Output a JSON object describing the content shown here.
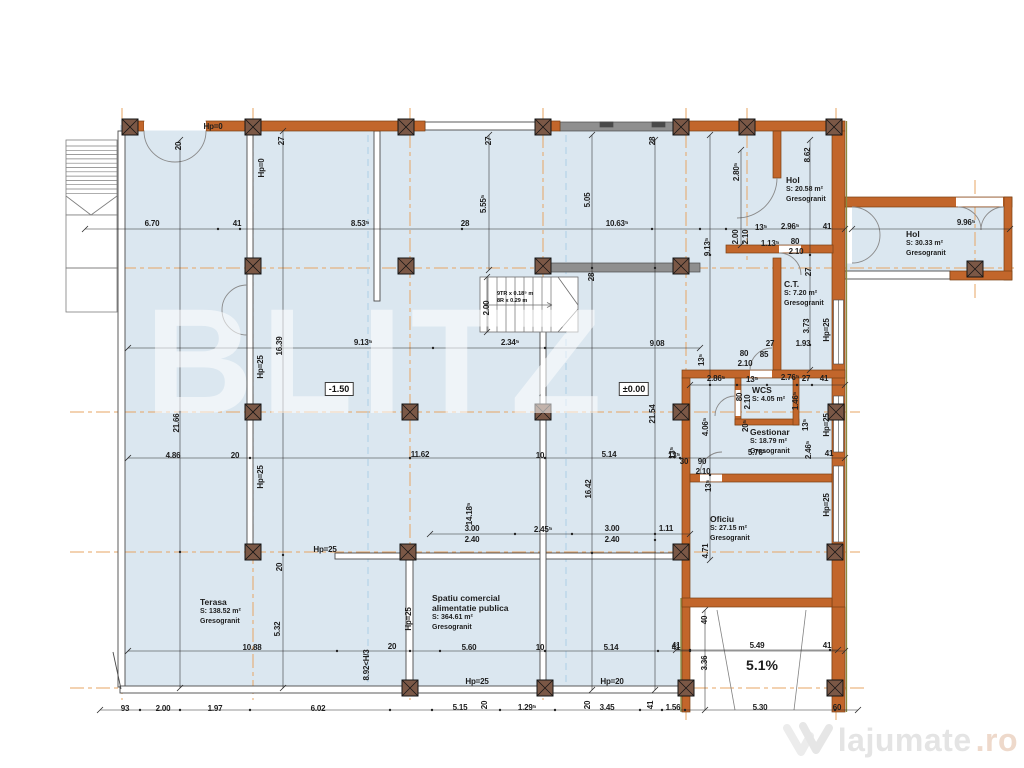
{
  "plan_watermark": "BLITZ",
  "watermark": {
    "brand": "lajumate",
    "tld": ".ro",
    "logo": "w-heart-icon"
  },
  "plan": {
    "levels": [
      {
        "t": "-1.50",
        "x": 339,
        "y": 389
      },
      {
        "t": "±0.00",
        "x": 634,
        "y": 389
      }
    ],
    "ramp_slope": {
      "t": "5.1%",
      "x": 762,
      "y": 665
    },
    "stair_note": {
      "x": 497,
      "y": 291,
      "lines": [
        "9TR x 0.18⁵ m",
        "8R x 0.29 m"
      ]
    },
    "rooms": [
      {
        "x": 786,
        "y": 176,
        "lines": [
          "Hol"
        ],
        "area": "S: 20.58 m²",
        "finish": "Gresogranit"
      },
      {
        "x": 906,
        "y": 230,
        "lines": [
          "Hol"
        ],
        "area": "S: 30.33 m²",
        "finish": "Gresogranit"
      },
      {
        "x": 784,
        "y": 280,
        "lines": [
          "C.T."
        ],
        "area": "S: 7.20 m²",
        "finish": "Gresogranit"
      },
      {
        "x": 752,
        "y": 386,
        "lines": [
          "WCS"
        ],
        "area": "S: 4.05 m²",
        "finish": ""
      },
      {
        "x": 750,
        "y": 428,
        "lines": [
          "Gestionar"
        ],
        "area": "S: 18.79 m²",
        "finish": "Gresogranit"
      },
      {
        "x": 710,
        "y": 515,
        "lines": [
          "Oficiu"
        ],
        "area": "S: 27.15 m²",
        "finish": "Gresogranit"
      },
      {
        "x": 200,
        "y": 598,
        "lines": [
          "Terasa"
        ],
        "area": "S: 138.52 m²",
        "finish": "Gresogranit"
      },
      {
        "x": 432,
        "y": 594,
        "lines": [
          "Spatiu comercial",
          "alimentatie publica"
        ],
        "area": "S: 364.61 m²",
        "finish": "Gresogranit"
      }
    ],
    "dims": [
      {
        "t": "Hp=0",
        "x": 213,
        "y": 127
      },
      {
        "t": "20",
        "x": 179,
        "y": 146,
        "v": 1
      },
      {
        "t": "27",
        "x": 282,
        "y": 141,
        "v": 1
      },
      {
        "t": "Hp=0",
        "x": 262,
        "y": 168,
        "v": 1
      },
      {
        "t": "6.70",
        "x": 152,
        "y": 224
      },
      {
        "t": "41",
        "x": 237,
        "y": 224
      },
      {
        "t": "8.53⁵",
        "x": 360,
        "y": 224
      },
      {
        "t": "28",
        "x": 465,
        "y": 224
      },
      {
        "t": "27",
        "x": 489,
        "y": 141,
        "v": 1
      },
      {
        "t": "5.55⁵",
        "x": 484,
        "y": 204,
        "v": 1
      },
      {
        "t": "28",
        "x": 653,
        "y": 141,
        "v": 1
      },
      {
        "t": "5.05",
        "x": 588,
        "y": 200,
        "v": 1
      },
      {
        "t": "10.63⁵",
        "x": 617,
        "y": 224
      },
      {
        "t": "28",
        "x": 592,
        "y": 277,
        "v": 1
      },
      {
        "t": "9.13⁵",
        "x": 708,
        "y": 247,
        "v": 1
      },
      {
        "t": "2.80⁵",
        "x": 737,
        "y": 172,
        "v": 1
      },
      {
        "t": "8.62",
        "x": 808,
        "y": 155,
        "v": 1
      },
      {
        "t": "2.00",
        "x": 736,
        "y": 237,
        "v": 1
      },
      {
        "t": "2.10",
        "x": 746,
        "y": 237,
        "v": 1
      },
      {
        "t": "13⁵",
        "x": 761,
        "y": 228
      },
      {
        "t": "2.96⁵",
        "x": 790,
        "y": 227
      },
      {
        "t": "41",
        "x": 827,
        "y": 227
      },
      {
        "t": "1.13⁵",
        "x": 770,
        "y": 244
      },
      {
        "t": "80",
        "x": 795,
        "y": 242
      },
      {
        "t": "2.10",
        "x": 796,
        "y": 252
      },
      {
        "t": "9.96⁵",
        "x": 966,
        "y": 223
      },
      {
        "t": "27",
        "x": 809,
        "y": 272,
        "v": 1
      },
      {
        "t": "3.73",
        "x": 807,
        "y": 326,
        "v": 1
      },
      {
        "t": "1.93",
        "x": 803,
        "y": 344
      },
      {
        "t": "27",
        "x": 770,
        "y": 344
      },
      {
        "t": "Hp=25",
        "x": 827,
        "y": 330,
        "v": 1
      },
      {
        "t": "80",
        "x": 744,
        "y": 354
      },
      {
        "t": "2.10",
        "x": 745,
        "y": 364
      },
      {
        "t": "85",
        "x": 764,
        "y": 355
      },
      {
        "t": "13⁵",
        "x": 702,
        "y": 360,
        "v": 1
      },
      {
        "t": "2.86⁵",
        "x": 716,
        "y": 379
      },
      {
        "t": "13⁵",
        "x": 752,
        "y": 380
      },
      {
        "t": "2.76⁵",
        "x": 790,
        "y": 378
      },
      {
        "t": "27",
        "x": 806,
        "y": 379
      },
      {
        "t": "41",
        "x": 824,
        "y": 379
      },
      {
        "t": "80",
        "x": 740,
        "y": 397,
        "v": 1
      },
      {
        "t": "2.10",
        "x": 748,
        "y": 402,
        "v": 1
      },
      {
        "t": "1.46⁵",
        "x": 796,
        "y": 401,
        "v": 1
      },
      {
        "t": "20⁵",
        "x": 746,
        "y": 426,
        "v": 1
      },
      {
        "t": "4.06⁵",
        "x": 706,
        "y": 427,
        "v": 1
      },
      {
        "t": "13⁵",
        "x": 806,
        "y": 425,
        "v": 1
      },
      {
        "t": "5.76⁵",
        "x": 757,
        "y": 453
      },
      {
        "t": "2.46⁵",
        "x": 809,
        "y": 450,
        "v": 1
      },
      {
        "t": "41",
        "x": 829,
        "y": 454
      },
      {
        "t": "90",
        "x": 702,
        "y": 462
      },
      {
        "t": "2.10",
        "x": 703,
        "y": 472
      },
      {
        "t": "30",
        "x": 684,
        "y": 462
      },
      {
        "t": "13⁵",
        "x": 673,
        "y": 453,
        "v": 1
      },
      {
        "t": "13⁵",
        "x": 709,
        "y": 486,
        "v": 1
      },
      {
        "t": "Hp=25",
        "x": 827,
        "y": 425,
        "v": 1
      },
      {
        "t": "Hp=25",
        "x": 827,
        "y": 505,
        "v": 1
      },
      {
        "t": "4.71",
        "x": 706,
        "y": 551,
        "v": 1
      },
      {
        "t": "16.39",
        "x": 280,
        "y": 346,
        "v": 1
      },
      {
        "t": "Hp=25",
        "x": 261,
        "y": 367,
        "v": 1
      },
      {
        "t": "Hp=25",
        "x": 261,
        "y": 477,
        "v": 1
      },
      {
        "t": "9.13⁵",
        "x": 363,
        "y": 343
      },
      {
        "t": "2.34⁵",
        "x": 510,
        "y": 343
      },
      {
        "t": "9.08",
        "x": 657,
        "y": 344
      },
      {
        "t": "2.00",
        "x": 487,
        "y": 308,
        "v": 1
      },
      {
        "t": "21.66",
        "x": 177,
        "y": 423,
        "v": 1
      },
      {
        "t": "21.54",
        "x": 653,
        "y": 414,
        "v": 1
      },
      {
        "t": "4.86",
        "x": 173,
        "y": 456
      },
      {
        "t": "20",
        "x": 235,
        "y": 456
      },
      {
        "t": "11.62",
        "x": 420,
        "y": 455
      },
      {
        "t": "10",
        "x": 540,
        "y": 456
      },
      {
        "t": "5.14",
        "x": 609,
        "y": 455
      },
      {
        "t": "13⁵",
        "x": 674,
        "y": 456
      },
      {
        "t": "16.42",
        "x": 589,
        "y": 489,
        "v": 1
      },
      {
        "t": "14.18⁵",
        "x": 470,
        "y": 514,
        "v": 1
      },
      {
        "t": "3.00",
        "x": 472,
        "y": 529
      },
      {
        "t": "2.40",
        "x": 472,
        "y": 540
      },
      {
        "t": "2.45⁵",
        "x": 543,
        "y": 530
      },
      {
        "t": "3.00",
        "x": 612,
        "y": 529
      },
      {
        "t": "2.40",
        "x": 612,
        "y": 540
      },
      {
        "t": "1.11",
        "x": 666,
        "y": 529
      },
      {
        "t": "Hp=25",
        "x": 325,
        "y": 550
      },
      {
        "t": "20",
        "x": 280,
        "y": 567,
        "v": 1
      },
      {
        "t": "5.32",
        "x": 278,
        "y": 629,
        "v": 1
      },
      {
        "t": "10.88",
        "x": 252,
        "y": 648
      },
      {
        "t": "20",
        "x": 392,
        "y": 647
      },
      {
        "t": "Hp=25",
        "x": 409,
        "y": 619,
        "v": 1
      },
      {
        "t": "8.92<H/3",
        "x": 367,
        "y": 665,
        "v": 1
      },
      {
        "t": "5.60",
        "x": 469,
        "y": 648
      },
      {
        "t": "10",
        "x": 540,
        "y": 648
      },
      {
        "t": "5.14",
        "x": 611,
        "y": 648
      },
      {
        "t": "41",
        "x": 676,
        "y": 648
      },
      {
        "t": "Hp=25",
        "x": 477,
        "y": 682
      },
      {
        "t": "Hp=20",
        "x": 612,
        "y": 682
      },
      {
        "t": "93",
        "x": 125,
        "y": 709
      },
      {
        "t": "2.00",
        "x": 163,
        "y": 709
      },
      {
        "t": "1.97",
        "x": 215,
        "y": 709
      },
      {
        "t": "6.02",
        "x": 318,
        "y": 709
      },
      {
        "t": "5.15",
        "x": 460,
        "y": 708
      },
      {
        "t": "20",
        "x": 485,
        "y": 705,
        "v": 1
      },
      {
        "t": "1.29⁵",
        "x": 527,
        "y": 708
      },
      {
        "t": "20",
        "x": 588,
        "y": 705,
        "v": 1
      },
      {
        "t": "3.45",
        "x": 607,
        "y": 708
      },
      {
        "t": "41",
        "x": 651,
        "y": 705,
        "v": 1
      },
      {
        "t": "1.56",
        "x": 673,
        "y": 708
      },
      {
        "t": "5.30",
        "x": 760,
        "y": 708
      },
      {
        "t": "60",
        "x": 837,
        "y": 708
      },
      {
        "t": "41",
        "x": 676,
        "y": 646
      },
      {
        "t": "5.49",
        "x": 757,
        "y": 646
      },
      {
        "t": "41",
        "x": 827,
        "y": 646
      },
      {
        "t": "40",
        "x": 705,
        "y": 620,
        "v": 1
      },
      {
        "t": "3.36",
        "x": 705,
        "y": 663,
        "v": 1
      }
    ]
  }
}
